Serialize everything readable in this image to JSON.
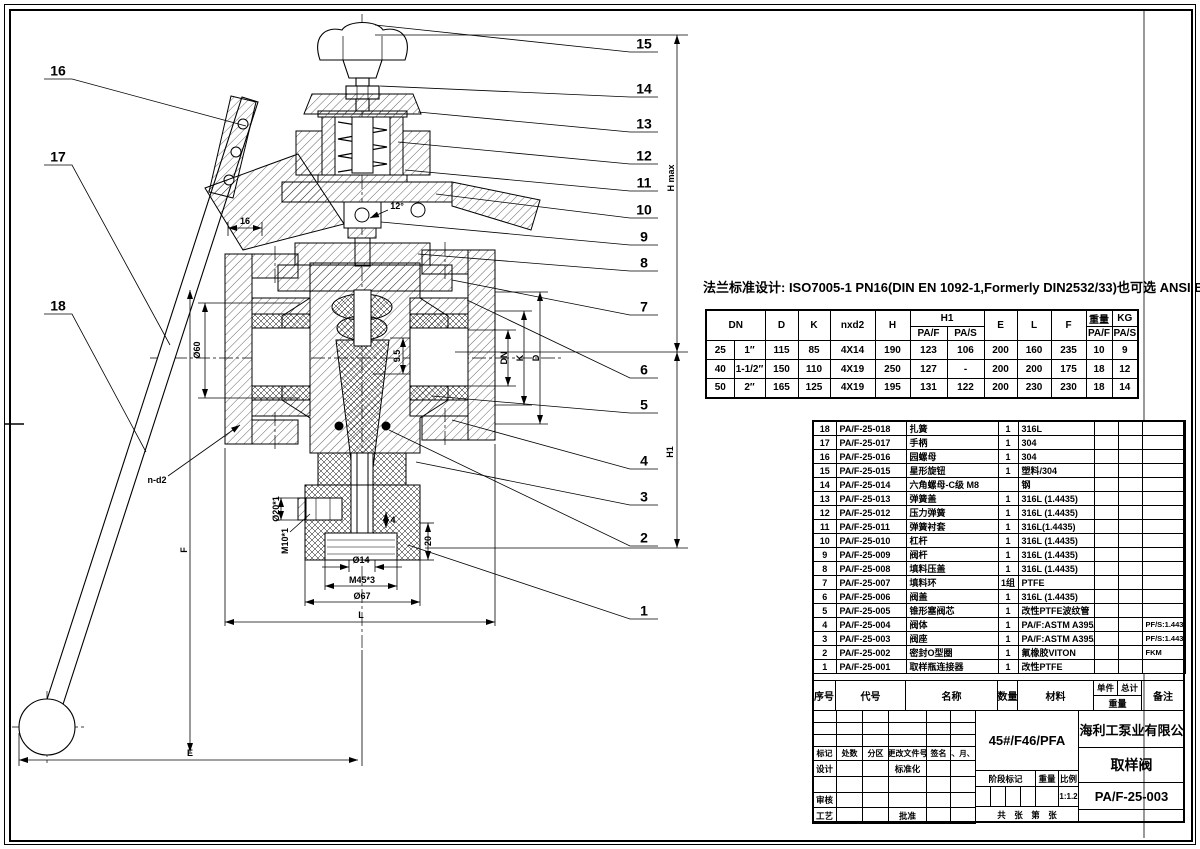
{
  "flange_note": "法兰标准设计: ISO7005-1 PN16(DIN EN 1092-1,Formerly DIN2532/33)也可选 ANSI BS JIS标准",
  "dim_table": {
    "headers": {
      "dn": "DN",
      "d": "D",
      "k": "K",
      "nxd2": "nxd2",
      "h": "H",
      "h1": "H1",
      "paf": "PA/F",
      "pas": "PA/S",
      "e": "E",
      "l": "L",
      "f": "F",
      "weight": "重量",
      "kg": "KG"
    },
    "rows": [
      [
        "25",
        "1″",
        "115",
        "85",
        "4X14",
        "190",
        "123",
        "106",
        "200",
        "160",
        "235",
        "10",
        "9"
      ],
      [
        "40",
        "1-1/2″",
        "150",
        "110",
        "4X19",
        "250",
        "127",
        "-",
        "200",
        "200",
        "175",
        "18",
        "12"
      ],
      [
        "50",
        "2″",
        "165",
        "125",
        "4X19",
        "195",
        "131",
        "122",
        "200",
        "230",
        "230",
        "18",
        "14"
      ]
    ]
  },
  "bom": {
    "headers": {
      "no": "序号",
      "code": "代号",
      "name": "名称",
      "qty": "数量",
      "material": "材料",
      "unit": "单件",
      "total": "总计",
      "weight": "重量",
      "remark": "备注"
    },
    "rows": [
      {
        "no": "18",
        "code": "PA/F-25-018",
        "name": "扎簧",
        "qty": "1",
        "material": "316L",
        "remark": ""
      },
      {
        "no": "17",
        "code": "PA/F-25-017",
        "name": "手柄",
        "qty": "1",
        "material": "304",
        "remark": ""
      },
      {
        "no": "16",
        "code": "PA/F-25-016",
        "name": "园螺母",
        "qty": "1",
        "material": "304",
        "remark": ""
      },
      {
        "no": "15",
        "code": "PA/F-25-015",
        "name": "星形旋钮",
        "qty": "1",
        "material": "塑料/304",
        "remark": ""
      },
      {
        "no": "14",
        "code": "PA/F-25-014",
        "name": "六角螺母-C级 M8",
        "qty": "",
        "material": "钢",
        "remark": ""
      },
      {
        "no": "13",
        "code": "PA/F-25-013",
        "name": "弹簧盖",
        "qty": "1",
        "material": "316L (1.4435)",
        "remark": ""
      },
      {
        "no": "12",
        "code": "PA/F-25-012",
        "name": "压力弹簧",
        "qty": "1",
        "material": "316L (1.4435)",
        "remark": ""
      },
      {
        "no": "11",
        "code": "PA/F-25-011",
        "name": "弹簧衬套",
        "qty": "1",
        "material": "316L(1.4435)",
        "remark": ""
      },
      {
        "no": "10",
        "code": "PA/F-25-010",
        "name": "杠杆",
        "qty": "1",
        "material": "316L (1.4435)",
        "remark": ""
      },
      {
        "no": "9",
        "code": "PA/F-25-009",
        "name": "阀杆",
        "qty": "1",
        "material": "316L (1.4435)",
        "remark": ""
      },
      {
        "no": "8",
        "code": "PA/F-25-008",
        "name": "填料压盖",
        "qty": "1",
        "material": "316L (1.4435)",
        "remark": ""
      },
      {
        "no": "7",
        "code": "PA/F-25-007",
        "name": "填料环",
        "qty": "1组",
        "material": "PTFE",
        "remark": ""
      },
      {
        "no": "6",
        "code": "PA/F-25-006",
        "name": "阀盖",
        "qty": "1",
        "material": "316L (1.4435)",
        "remark": ""
      },
      {
        "no": "5",
        "code": "PA/F-25-005",
        "name": "锥形塞阀芯",
        "qty": "1",
        "material": "改性PTFE波纹管",
        "remark": ""
      },
      {
        "no": "4",
        "code": "PA/F-25-004",
        "name": "阀体",
        "qty": "1",
        "material": "PA/F:ASTM A395/PFA",
        "remark": "PF/S:1.4435"
      },
      {
        "no": "3",
        "code": "PA/F-25-003",
        "name": "阀座",
        "qty": "1",
        "material": "PA/F:ASTM A395/PFA",
        "remark": "PF/S:1.4435"
      },
      {
        "no": "2",
        "code": "PA/F-25-002",
        "name": "密封O型圈",
        "qty": "1",
        "material": "氟橡胶VITON",
        "remark": "FKM"
      },
      {
        "no": "1",
        "code": "PA/F-25-001",
        "name": "取样瓶连接器",
        "qty": "1",
        "material": "改性PTFE",
        "remark": ""
      }
    ]
  },
  "title_block": {
    "company": "上海利工泵业有限公司",
    "product": "取样阀",
    "drawing_no": "PA/F-25-003",
    "material_spec": "45#/F46/PFA",
    "scale_value": "1:1.2",
    "labels": {
      "mark": "标记",
      "count": "处数",
      "zone": "分区",
      "change_doc": "更改文件号",
      "signature": "签名",
      "date": "年、月、日",
      "design": "设计",
      "standardize": "标准化",
      "check": "审核",
      "process": "工艺",
      "approve": "批准",
      "stage_mark": "阶段标记",
      "weight": "重量",
      "scale": "比例",
      "total": "共",
      "sheet": "张",
      "number": "第",
      "sheet2": "张"
    }
  },
  "annotations": [
    {
      "t": "H max",
      "x": 671,
      "y": 178,
      "r": -90
    },
    {
      "t": "H1",
      "x": 670,
      "y": 452,
      "r": -90
    },
    {
      "t": "Ø60",
      "x": 197,
      "y": 350,
      "r": -90
    },
    {
      "t": "DN",
      "x": 504,
      "y": 358,
      "r": -90
    },
    {
      "t": "K",
      "x": 520,
      "y": 358,
      "r": -90
    },
    {
      "t": "D",
      "x": 536,
      "y": 358,
      "r": -90
    },
    {
      "t": "9.5",
      "x": 397,
      "y": 356,
      "r": -90
    },
    {
      "t": "16",
      "x": 245,
      "y": 221,
      "r": 0
    },
    {
      "t": "12°",
      "x": 397,
      "y": 206,
      "r": 0
    },
    {
      "t": "Ø20*1",
      "x": 276,
      "y": 509,
      "r": -90
    },
    {
      "t": "M10*1",
      "x": 285,
      "y": 541,
      "r": -90
    },
    {
      "t": "4",
      "x": 393,
      "y": 520,
      "r": 0
    },
    {
      "t": "20",
      "x": 428,
      "y": 541,
      "r": -90
    },
    {
      "t": "Ø14",
      "x": 361,
      "y": 560,
      "r": 0
    },
    {
      "t": "M45*3",
      "x": 362,
      "y": 580,
      "r": 0
    },
    {
      "t": "Ø67",
      "x": 362,
      "y": 596,
      "r": 0
    },
    {
      "t": "L",
      "x": 361,
      "y": 615,
      "r": 0
    },
    {
      "t": "E",
      "x": 190,
      "y": 753,
      "r": 0
    },
    {
      "t": "F",
      "x": 184,
      "y": 550,
      "r": -90
    },
    {
      "t": "n-d2",
      "x": 157,
      "y": 480,
      "r": 0
    }
  ],
  "balloons": [
    {
      "n": "15",
      "x": 644,
      "y": 52
    },
    {
      "n": "14",
      "x": 644,
      "y": 97
    },
    {
      "n": "13",
      "x": 644,
      "y": 132
    },
    {
      "n": "12",
      "x": 644,
      "y": 164
    },
    {
      "n": "11",
      "x": 644,
      "y": 191
    },
    {
      "n": "10",
      "x": 644,
      "y": 218
    },
    {
      "n": "9",
      "x": 644,
      "y": 245
    },
    {
      "n": "8",
      "x": 644,
      "y": 271
    },
    {
      "n": "7",
      "x": 644,
      "y": 315
    },
    {
      "n": "6",
      "x": 644,
      "y": 378
    },
    {
      "n": "5",
      "x": 644,
      "y": 413
    },
    {
      "n": "4",
      "x": 644,
      "y": 469
    },
    {
      "n": "3",
      "x": 644,
      "y": 505
    },
    {
      "n": "2",
      "x": 644,
      "y": 546
    },
    {
      "n": "1",
      "x": 644,
      "y": 619
    },
    {
      "n": "16",
      "x": 58,
      "y": 79
    },
    {
      "n": "17",
      "x": 58,
      "y": 165
    },
    {
      "n": "18",
      "x": 58,
      "y": 314
    }
  ]
}
